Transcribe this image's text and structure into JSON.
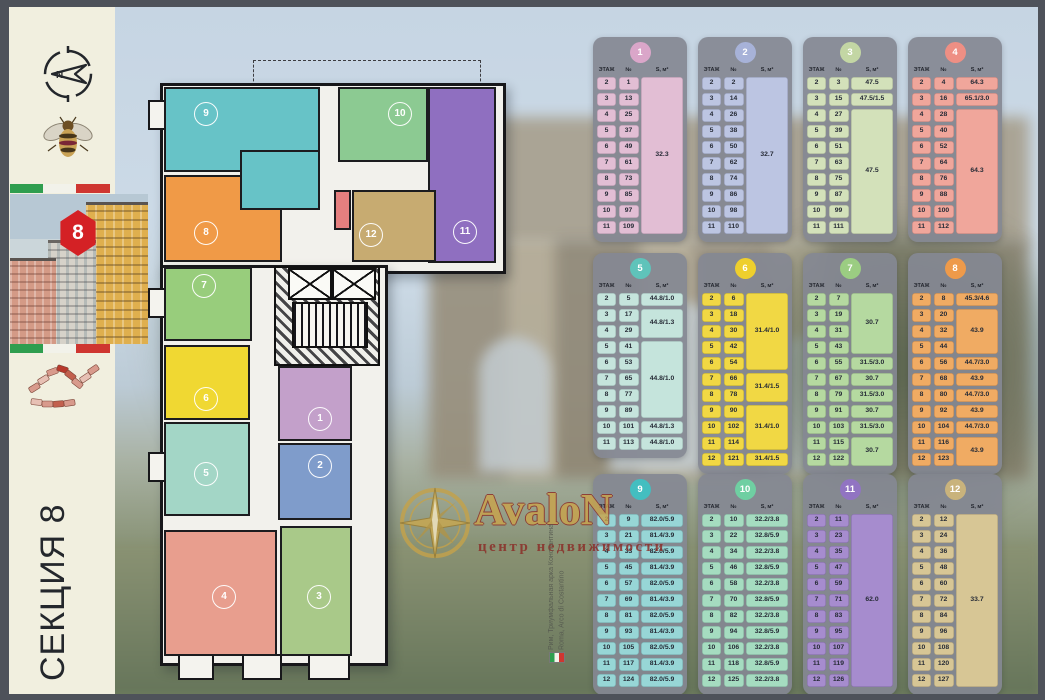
{
  "sidebar": {
    "section_label": "СЕКЦИЯ 8",
    "building_badge": "8"
  },
  "watermark": {
    "title": "AvaloN",
    "subtitle": "центр недвижимости"
  },
  "caption": {
    "line1": "Рим, Триумфальная арка Константина",
    "line2": "Roma, Arco di Costantino"
  },
  "table_header": {
    "floor": "ЭТАЖ",
    "num": "№",
    "area": "S, м²"
  },
  "plan": {
    "rooms": [
      {
        "id": "1",
        "color": "#c3a0ca"
      },
      {
        "id": "2",
        "color": "#7f9ccb"
      },
      {
        "id": "3",
        "color": "#a9c989"
      },
      {
        "id": "4",
        "color": "#e89e8e"
      },
      {
        "id": "5",
        "color": "#a3d6c6"
      },
      {
        "id": "6",
        "color": "#f0d832"
      },
      {
        "id": "7",
        "color": "#98cd7c"
      },
      {
        "id": "8",
        "color": "#f09a47"
      },
      {
        "id": "9",
        "color": "#67c3c7"
      },
      {
        "id": "10",
        "color": "#8cca92"
      },
      {
        "id": "11",
        "color": "#8f6fc0"
      },
      {
        "id": "12",
        "color": "#c7ab71"
      }
    ],
    "utility_room_color": "#e57f7f"
  },
  "tables": [
    {
      "id": "1",
      "badge_color": "#daa6c9",
      "cell_color": "#e2bed4",
      "floors": [
        "2",
        "3",
        "4",
        "5",
        "6",
        "7",
        "8",
        "9",
        "10",
        "11"
      ],
      "nums": [
        "1",
        "13",
        "25",
        "37",
        "49",
        "61",
        "73",
        "85",
        "97",
        "109"
      ],
      "areas": [
        {
          "from": 0,
          "to": 9,
          "value": "32.3"
        }
      ]
    },
    {
      "id": "2",
      "badge_color": "#a7b2d8",
      "cell_color": "#bcc5e2",
      "floors": [
        "2",
        "3",
        "4",
        "5",
        "6",
        "7",
        "8",
        "9",
        "10",
        "11"
      ],
      "nums": [
        "2",
        "14",
        "26",
        "38",
        "50",
        "62",
        "74",
        "86",
        "98",
        "110"
      ],
      "areas": [
        {
          "from": 0,
          "to": 9,
          "value": "32.7"
        }
      ]
    },
    {
      "id": "3",
      "badge_color": "#c3d6a4",
      "cell_color": "#d3e1ba",
      "floors": [
        "2",
        "3",
        "4",
        "5",
        "6",
        "7",
        "8",
        "9",
        "10",
        "11"
      ],
      "nums": [
        "3",
        "15",
        "27",
        "39",
        "51",
        "63",
        "75",
        "87",
        "99",
        "111"
      ],
      "areas": [
        {
          "from": 0,
          "to": 0,
          "value": "47.5"
        },
        {
          "from": 1,
          "to": 1,
          "value": "47.5/1.5"
        },
        {
          "from": 2,
          "to": 9,
          "value": "47.5"
        }
      ]
    },
    {
      "id": "4",
      "badge_color": "#ee8f84",
      "cell_color": "#f0a69b",
      "floors": [
        "2",
        "3",
        "4",
        "5",
        "6",
        "7",
        "8",
        "9",
        "10",
        "11"
      ],
      "nums": [
        "4",
        "16",
        "28",
        "40",
        "52",
        "64",
        "76",
        "88",
        "100",
        "112"
      ],
      "areas": [
        {
          "from": 0,
          "to": 0,
          "value": "64.3"
        },
        {
          "from": 1,
          "to": 1,
          "value": "65.1/3.0"
        },
        {
          "from": 2,
          "to": 9,
          "value": "64.3"
        }
      ]
    },
    {
      "id": "5",
      "badge_color": "#5fc3ba",
      "cell_color": "#c5e4dc",
      "floors": [
        "2",
        "3",
        "4",
        "5",
        "6",
        "7",
        "8",
        "9",
        "10",
        "11"
      ],
      "nums": [
        "5",
        "17",
        "29",
        "41",
        "53",
        "65",
        "77",
        "89",
        "101",
        "113"
      ],
      "areas": [
        {
          "from": 0,
          "to": 0,
          "value": "44.8/1.0"
        },
        {
          "from": 1,
          "to": 2,
          "value": "44.8/1.3"
        },
        {
          "from": 3,
          "to": 7,
          "value": "44.8/1.0"
        },
        {
          "from": 8,
          "to": 8,
          "value": "44.8/1.3"
        },
        {
          "from": 9,
          "to": 9,
          "value": "44.8/1.0"
        }
      ]
    },
    {
      "id": "6",
      "badge_color": "#eecf2d",
      "cell_color": "#f1d844",
      "floors": [
        "2",
        "3",
        "4",
        "5",
        "6",
        "7",
        "8",
        "9",
        "10",
        "11",
        "12"
      ],
      "nums": [
        "6",
        "18",
        "30",
        "42",
        "54",
        "66",
        "78",
        "90",
        "102",
        "114",
        "121"
      ],
      "areas": [
        {
          "from": 0,
          "to": 4,
          "value": "31.4/1.0"
        },
        {
          "from": 5,
          "to": 6,
          "value": "31.4/1.5"
        },
        {
          "from": 7,
          "to": 9,
          "value": "31.4/1.0"
        },
        {
          "from": 10,
          "to": 10,
          "value": "31.4/1.5"
        }
      ]
    },
    {
      "id": "7",
      "badge_color": "#9bcd82",
      "cell_color": "#b5d9a0",
      "floors": [
        "2",
        "3",
        "4",
        "5",
        "6",
        "7",
        "8",
        "9",
        "10",
        "11",
        "12"
      ],
      "nums": [
        "7",
        "19",
        "31",
        "43",
        "55",
        "67",
        "79",
        "91",
        "103",
        "115",
        "122"
      ],
      "areas": [
        {
          "from": 0,
          "to": 3,
          "value": "30.7"
        },
        {
          "from": 4,
          "to": 4,
          "value": "31.5/3.0"
        },
        {
          "from": 5,
          "to": 5,
          "value": "30.7"
        },
        {
          "from": 6,
          "to": 6,
          "value": "31.5/3.0"
        },
        {
          "from": 7,
          "to": 7,
          "value": "30.7"
        },
        {
          "from": 8,
          "to": 8,
          "value": "31.5/3.0"
        },
        {
          "from": 9,
          "to": 10,
          "value": "30.7"
        }
      ]
    },
    {
      "id": "8",
      "badge_color": "#ee9a4a",
      "cell_color": "#f0ab63",
      "floors": [
        "2",
        "3",
        "4",
        "5",
        "6",
        "7",
        "8",
        "9",
        "10",
        "11",
        "12"
      ],
      "nums": [
        "8",
        "20",
        "32",
        "44",
        "56",
        "68",
        "80",
        "92",
        "104",
        "116",
        "123"
      ],
      "areas": [
        {
          "from": 0,
          "to": 0,
          "value": "45.3/4.6"
        },
        {
          "from": 1,
          "to": 3,
          "value": "43.9"
        },
        {
          "from": 4,
          "to": 4,
          "value": "44.7/3.0"
        },
        {
          "from": 5,
          "to": 5,
          "value": "43.9"
        },
        {
          "from": 6,
          "to": 6,
          "value": "44.7/3.0"
        },
        {
          "from": 7,
          "to": 7,
          "value": "43.9"
        },
        {
          "from": 8,
          "to": 8,
          "value": "44.7/3.0"
        },
        {
          "from": 9,
          "to": 10,
          "value": "43.9"
        }
      ]
    },
    {
      "id": "9",
      "badge_color": "#43bec0",
      "cell_color": "#97d6d6",
      "floors": [
        "2",
        "3",
        "4",
        "5",
        "6",
        "7",
        "8",
        "9",
        "10",
        "11",
        "12"
      ],
      "nums": [
        "9",
        "21",
        "33",
        "45",
        "57",
        "69",
        "81",
        "93",
        "105",
        "117",
        "124"
      ],
      "areas": [
        {
          "from": 0,
          "to": 0,
          "value": "82.0/5.9"
        },
        {
          "from": 1,
          "to": 1,
          "value": "81.4/3.9"
        },
        {
          "from": 2,
          "to": 2,
          "value": "82.0/5.9"
        },
        {
          "from": 3,
          "to": 3,
          "value": "81.4/3.9"
        },
        {
          "from": 4,
          "to": 4,
          "value": "82.0/5.9"
        },
        {
          "from": 5,
          "to": 5,
          "value": "81.4/3.9"
        },
        {
          "from": 6,
          "to": 6,
          "value": "82.0/5.9"
        },
        {
          "from": 7,
          "to": 7,
          "value": "81.4/3.9"
        },
        {
          "from": 8,
          "to": 8,
          "value": "82.0/5.9"
        },
        {
          "from": 9,
          "to": 9,
          "value": "81.4/3.9"
        },
        {
          "from": 10,
          "to": 10,
          "value": "82.0/5.9"
        }
      ]
    },
    {
      "id": "10",
      "badge_color": "#6fcfa2",
      "cell_color": "#a5dcc0",
      "floors": [
        "2",
        "3",
        "4",
        "5",
        "6",
        "7",
        "8",
        "9",
        "10",
        "11",
        "12"
      ],
      "nums": [
        "10",
        "22",
        "34",
        "46",
        "58",
        "70",
        "82",
        "94",
        "106",
        "118",
        "125"
      ],
      "areas": [
        {
          "from": 0,
          "to": 0,
          "value": "32.2/3.8"
        },
        {
          "from": 1,
          "to": 1,
          "value": "32.8/5.9"
        },
        {
          "from": 2,
          "to": 2,
          "value": "32.2/3.8"
        },
        {
          "from": 3,
          "to": 3,
          "value": "32.8/5.9"
        },
        {
          "from": 4,
          "to": 4,
          "value": "32.2/3.8"
        },
        {
          "from": 5,
          "to": 5,
          "value": "32.8/5.9"
        },
        {
          "from": 6,
          "to": 6,
          "value": "32.2/3.8"
        },
        {
          "from": 7,
          "to": 7,
          "value": "32.8/5.9"
        },
        {
          "from": 8,
          "to": 8,
          "value": "32.2/3.8"
        },
        {
          "from": 9,
          "to": 9,
          "value": "32.8/5.9"
        },
        {
          "from": 10,
          "to": 10,
          "value": "32.2/3.8"
        }
      ]
    },
    {
      "id": "11",
      "badge_color": "#9174c2",
      "cell_color": "#a68cce",
      "floors": [
        "2",
        "3",
        "4",
        "5",
        "6",
        "7",
        "8",
        "9",
        "10",
        "11",
        "12"
      ],
      "nums": [
        "11",
        "23",
        "35",
        "47",
        "59",
        "71",
        "83",
        "95",
        "107",
        "119",
        "126"
      ],
      "areas": [
        {
          "from": 0,
          "to": 10,
          "value": "62.0"
        }
      ]
    },
    {
      "id": "12",
      "badge_color": "#c9b37c",
      "cell_color": "#d7c695",
      "floors": [
        "2",
        "3",
        "4",
        "5",
        "6",
        "7",
        "8",
        "9",
        "10",
        "11",
        "12"
      ],
      "nums": [
        "12",
        "24",
        "36",
        "48",
        "60",
        "72",
        "84",
        "96",
        "108",
        "120",
        "127"
      ],
      "areas": [
        {
          "from": 0,
          "to": 10,
          "value": "33.7"
        }
      ]
    }
  ]
}
